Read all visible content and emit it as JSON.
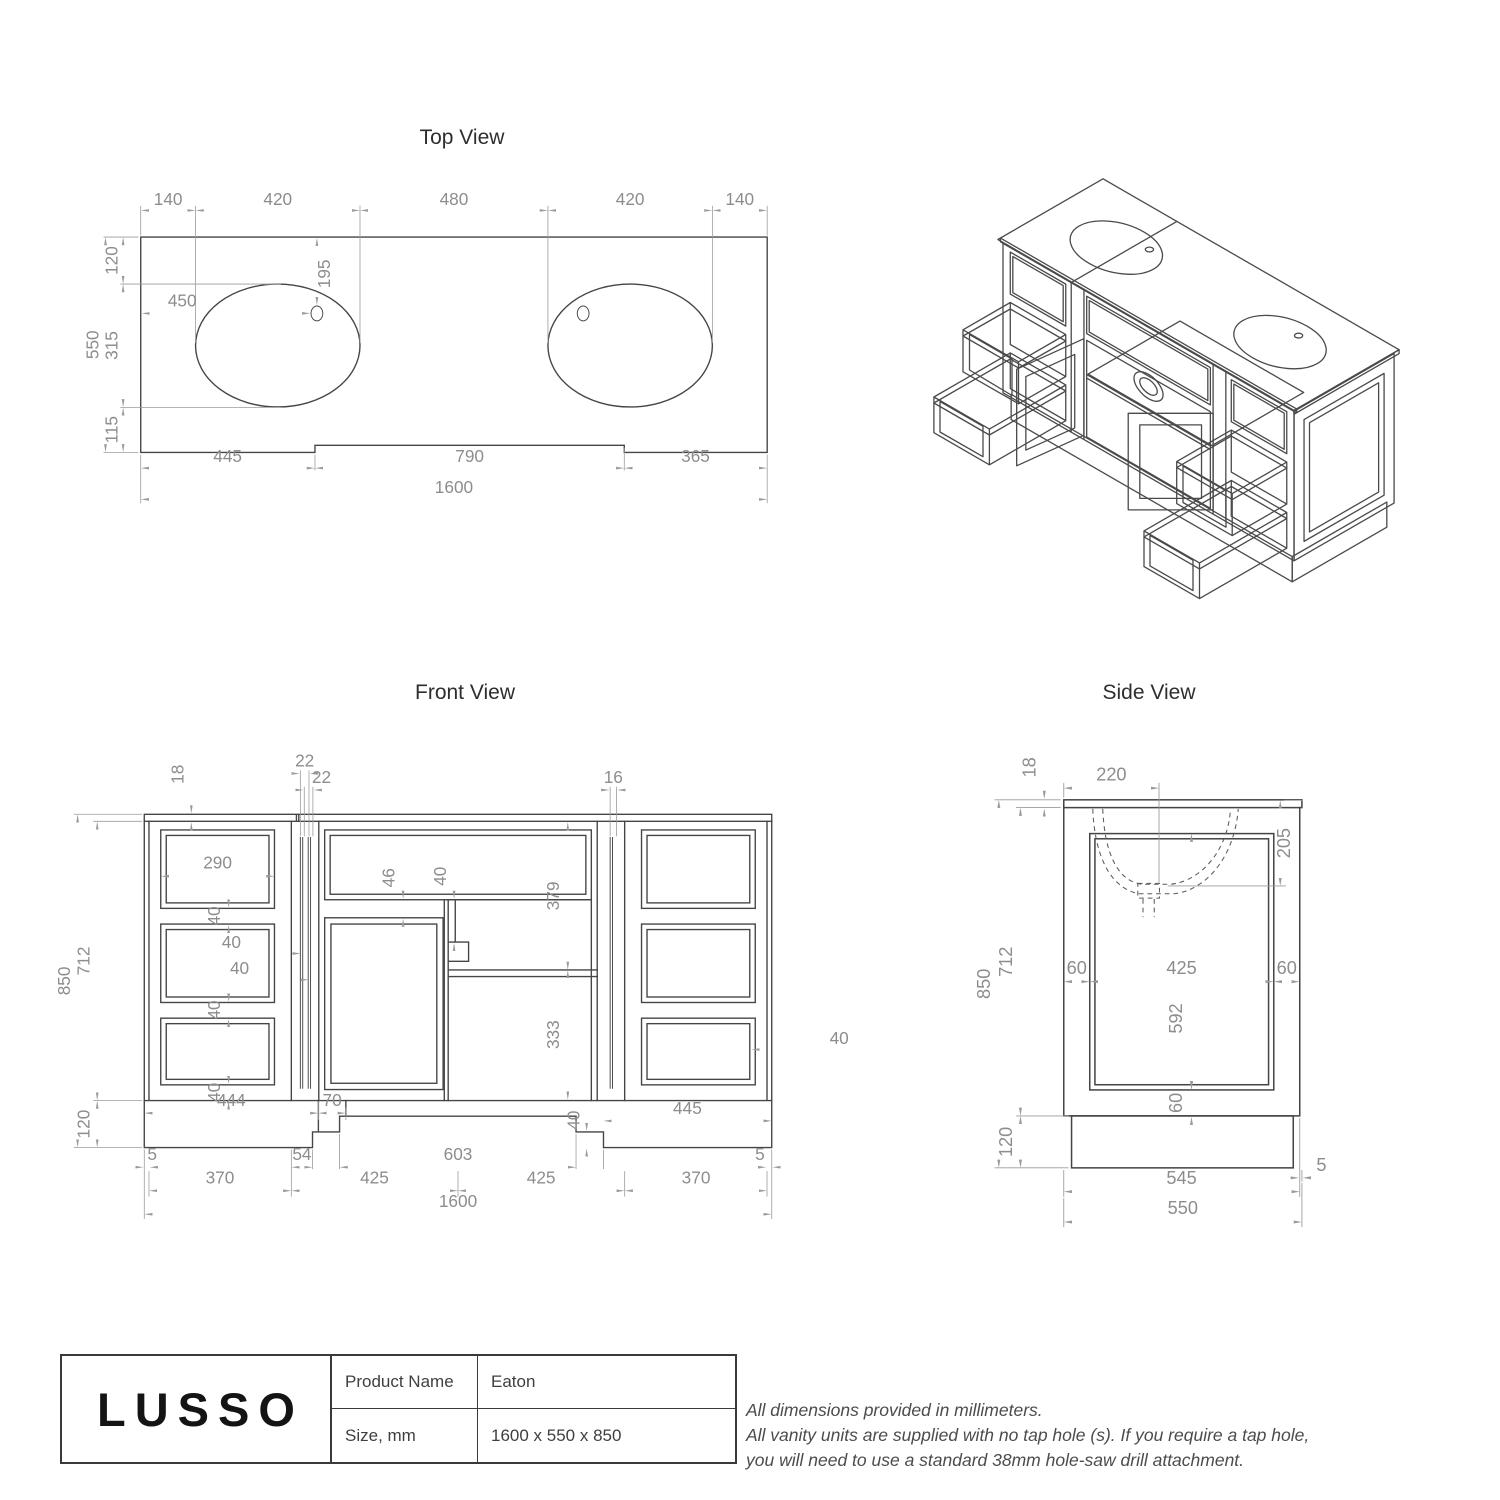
{
  "views": {
    "top": {
      "title": "Top View",
      "d": {
        "w140a": "140",
        "w420a": "420",
        "w480": "480",
        "w420b": "420",
        "w140b": "140",
        "h550": "550",
        "h120": "120",
        "h315": "315",
        "h115": "115",
        "c450": "450",
        "c195": "195",
        "b445": "445",
        "b790": "790",
        "b365": "365",
        "total": "1600"
      }
    },
    "front": {
      "title": "Front View",
      "d": {
        "t18": "18",
        "t22a": "22",
        "t22b": "22",
        "t16": "16",
        "h850": "850",
        "h712": "712",
        "h120": "120",
        "w290": "290",
        "g40a": "40",
        "g40b": "40",
        "g40c": "40",
        "p40a": "40",
        "p40b": "40",
        "f46": "46",
        "f40": "40",
        "v379": "379",
        "v333": "333",
        "r40": "40",
        "p444": "444",
        "p70": "70",
        "p445": "445",
        "a40": "40",
        "b5l": "5",
        "b54": "54",
        "b603": "603",
        "b5r": "5",
        "b370l": "370",
        "b425a": "425",
        "b425b": "425",
        "b370r": "370",
        "total": "1600"
      }
    },
    "side": {
      "title": "Side View",
      "d": {
        "t220": "220",
        "t18": "18",
        "r205": "205",
        "h850": "850",
        "h712": "712",
        "h120": "120",
        "m60l": "60",
        "m425": "425",
        "m60r": "60",
        "v592": "592",
        "v60": "60",
        "b545": "545",
        "b5": "5",
        "b550": "550"
      }
    }
  },
  "title_block": {
    "brand": "LUSSO",
    "product_label": "Product Name",
    "product_value": "Eaton",
    "size_label": "Size, mm",
    "size_value": "1600 x 550 x 850"
  },
  "notes": {
    "line1": "All dimensions provided in millimeters.",
    "line2": "All vanity units are supplied with no tap hole (s). If you require a tap hole,",
    "line3": "you will need to use a standard 38mm hole-saw drill attachment."
  },
  "colors": {
    "object_line": "#454545",
    "dimension_line": "#9b9b9b",
    "dimension_text": "#8d8d8d",
    "title_text": "#2e2e2e"
  }
}
